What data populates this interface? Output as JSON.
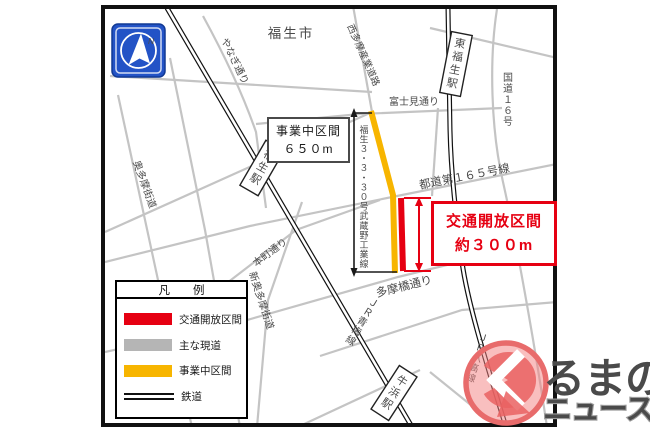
{
  "map": {
    "city": "福生市",
    "compass_n": "N",
    "roads": {
      "yanagi": "やなぎ通り",
      "nishitama_sangyo": "西多摩産業道路",
      "fujimi": "富士見通り",
      "route16": "国道１６号",
      "todo165": "都道第１６５号線",
      "tamabashi": "多摩橋通り",
      "honcho": "本町通り",
      "shin_okutama": "新奥多摩街道",
      "okutama": "奥多摩街道",
      "new_road": "福生３・３・３０号武蔵野工業線"
    },
    "railways": {
      "ome": "ＪＲ青梅線",
      "hachiko": "ＪＲ八高線"
    },
    "stations": {
      "fussa": "福生駅",
      "higashi_fussa": "東福生駅",
      "ushihama": "牛浜駅"
    }
  },
  "callouts": {
    "construction": {
      "line1": "事業中区間",
      "line2": "６５０m"
    },
    "opening": {
      "line1": "交通開放区間",
      "line2": "約３００m"
    }
  },
  "legend": {
    "title": "凡　　例",
    "items": [
      {
        "label": "交通開放区間"
      },
      {
        "label": "主な現道"
      },
      {
        "label": "事業中区間"
      },
      {
        "label": "鉄道"
      }
    ]
  },
  "watermark": {
    "top": "るまの",
    "bottom": "ニュース"
  },
  "colors": {
    "open_red": "#e60012",
    "existing_gray": "#b5b5b5",
    "construction_yellow": "#f7b500",
    "compass_blue": "#2353c6"
  }
}
